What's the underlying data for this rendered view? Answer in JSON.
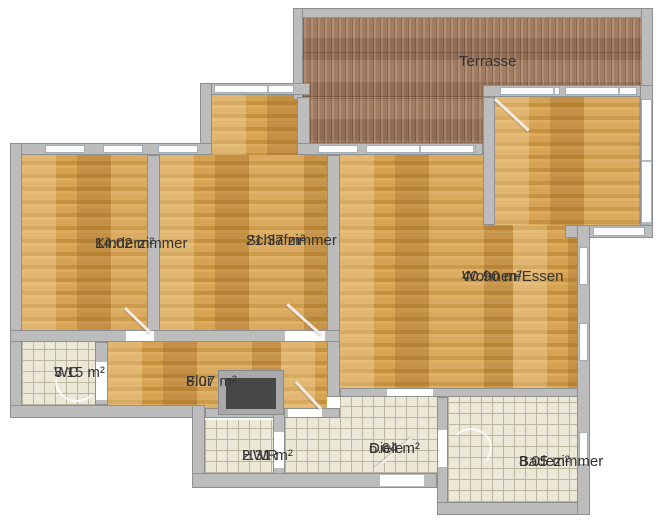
{
  "rooms": {
    "terrasse": {
      "name": "Terrasse",
      "area": ""
    },
    "kinderzimmer": {
      "name": "Kinderzimmer",
      "area": "14.02 m²"
    },
    "schlafzimmer": {
      "name": "Schlafzimmer",
      "area": "21.37 m²"
    },
    "wohnen_essen": {
      "name": "Wohnen/Essen",
      "area": "40.90 m²"
    },
    "wc": {
      "name": "WC",
      "area": "3.15 m²"
    },
    "flur": {
      "name": "Flur",
      "area": "8.07 m²"
    },
    "hwr": {
      "name": "HWR",
      "area": "2.31 m²"
    },
    "diele": {
      "name": "Diele",
      "area": "6.64 m²"
    },
    "badezimmer": {
      "name": "Badezimmer",
      "area": "8.05 m²"
    }
  },
  "colors": {
    "wood_floor": "#cd9848",
    "terrace_deck": "#aa8164",
    "tile_floor": "#ece8d7",
    "wall": "#bcbcbc",
    "window": "#fdfeff",
    "shaft": "#474747",
    "label_text": "#333333"
  }
}
